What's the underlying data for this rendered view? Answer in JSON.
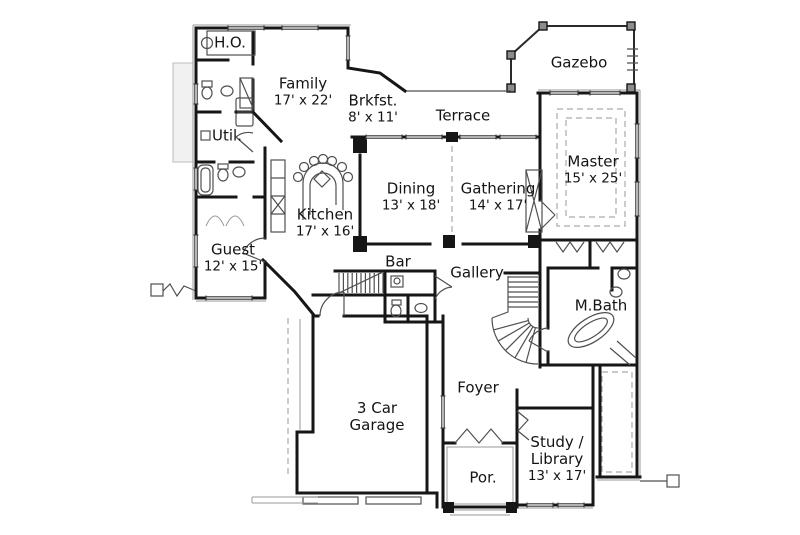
{
  "palette": {
    "wall_ink": "#161616",
    "thin_ink": "#4f4f4f",
    "dashed_ink": "#aaaaaa",
    "background": "#ffffff",
    "text": "#141414"
  },
  "rooms": {
    "ho": {
      "lines": [
        "H.O."
      ]
    },
    "family": {
      "lines": [
        "Family",
        "17' x 22'"
      ]
    },
    "brkfst": {
      "lines": [
        "Brkfst.",
        "8' x 11'"
      ]
    },
    "terrace": {
      "lines": [
        "Terrace"
      ]
    },
    "gazebo": {
      "lines": [
        "Gazebo"
      ]
    },
    "util": {
      "lines": [
        "Util."
      ]
    },
    "kitchen": {
      "lines": [
        "Kitchen",
        "17' x 16'"
      ]
    },
    "dining": {
      "lines": [
        "Dining",
        "13' x 18'"
      ]
    },
    "gathering": {
      "lines": [
        "Gathering",
        "14' x 17'"
      ]
    },
    "master": {
      "lines": [
        "Master",
        "15' x 25'"
      ]
    },
    "guest": {
      "lines": [
        "Guest",
        "12' x 15'"
      ]
    },
    "bar": {
      "lines": [
        "Bar"
      ]
    },
    "gallery": {
      "lines": [
        "Gallery"
      ]
    },
    "mbath": {
      "lines": [
        "M.Bath"
      ]
    },
    "foyer": {
      "lines": [
        "Foyer"
      ]
    },
    "garage": {
      "lines": [
        "3 Car",
        "Garage"
      ]
    },
    "por": {
      "lines": [
        "Por."
      ]
    },
    "study": {
      "lines": [
        "Study /",
        "Library",
        "13' x 17'"
      ]
    }
  }
}
